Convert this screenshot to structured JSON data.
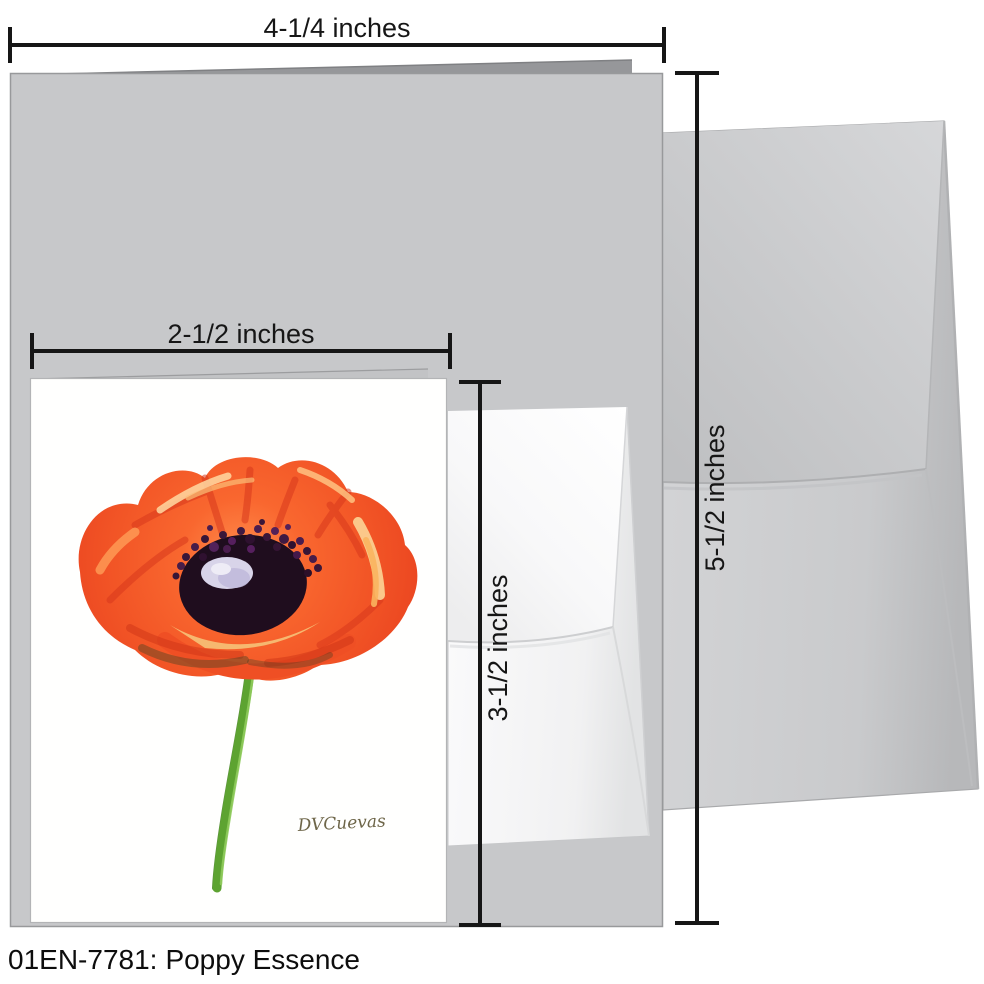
{
  "product": {
    "sku": "01EN-7781:",
    "title": "Poppy Essence",
    "signature": "DVCuevas"
  },
  "measurements": {
    "large_card_width": "4-1/4 inches",
    "large_card_height": "5-1/2 inches",
    "small_card_width": "2-1/2 inches",
    "small_card_height": "3-1/2 inches"
  },
  "colors": {
    "large_card_gray": "#c7c8ca",
    "large_envelope_gray": "#cdced0",
    "small_card_white": "#ffffff",
    "small_envelope_white": "#f6f6f7",
    "poppy_petal_orange": "#f25526",
    "poppy_center_dark": "#1f0d1e",
    "poppy_highlight": "#d8d4e9",
    "stem_green": "#5da331",
    "dimension_line_black": "#161616"
  }
}
